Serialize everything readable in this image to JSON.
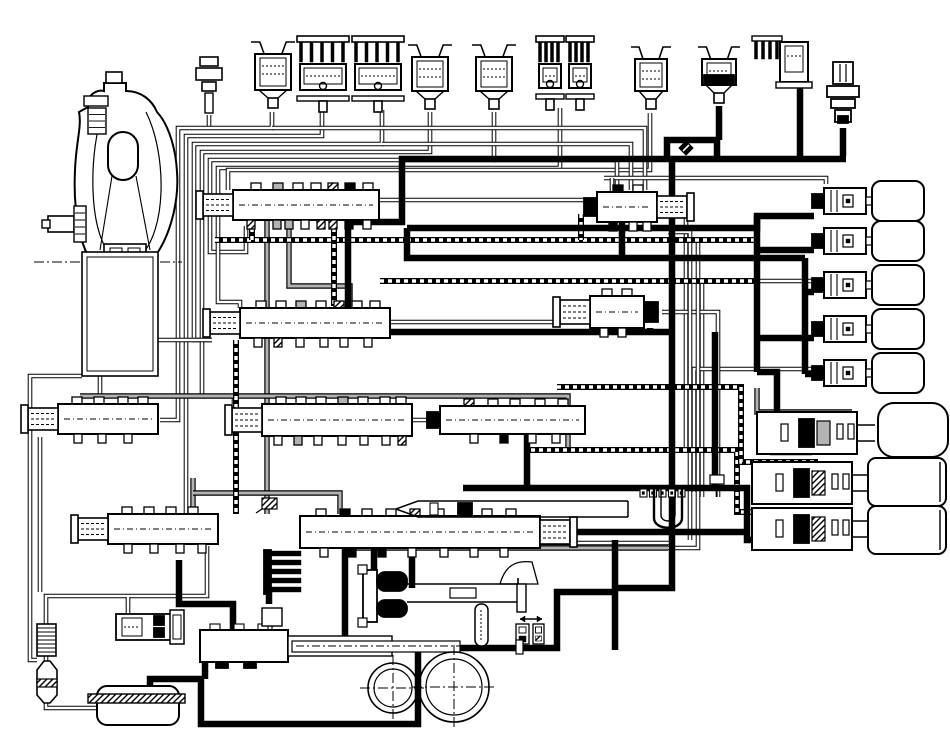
{
  "canvas": {
    "width": 950,
    "height": 742,
    "background": "#ffffff",
    "ink": "#000000",
    "gray": "#b3b3b3"
  },
  "diagram": {
    "kind": "transmission-hydraulic-circuit",
    "visible_text": [],
    "line_kinds": [
      "thin-double-passage",
      "gray-passage",
      "hatched-passage",
      "thick-supply"
    ]
  },
  "components": [
    {
      "name": "torque-converter",
      "type": "tc"
    },
    {
      "name": "converter-drum",
      "type": "drum"
    },
    {
      "name": "fluid-temp-sensor",
      "type": "sensor",
      "x": 194,
      "y": 55
    },
    {
      "name": "shift-solenoid-1",
      "type": "sol_cup",
      "x": 251,
      "y": 40,
      "w": 44,
      "h": 72
    },
    {
      "name": "linear-solenoid-1a",
      "type": "sol_fin",
      "x": 297,
      "y": 36,
      "w": 52,
      "h": 76
    },
    {
      "name": "linear-solenoid-1b",
      "type": "sol_fin",
      "x": 352,
      "y": 36,
      "w": 52,
      "h": 76
    },
    {
      "name": "shift-solenoid-2",
      "type": "sol_cup",
      "x": 408,
      "y": 43,
      "w": 44,
      "h": 70
    },
    {
      "name": "shift-solenoid-3",
      "type": "sol_cup",
      "x": 472,
      "y": 43,
      "w": 44,
      "h": 70
    },
    {
      "name": "linear-solenoid-2a",
      "type": "sol_fin",
      "x": 536,
      "y": 36,
      "w": 28,
      "h": 74
    },
    {
      "name": "linear-solenoid-2b",
      "type": "sol_fin",
      "x": 566,
      "y": 36,
      "w": 28,
      "h": 74
    },
    {
      "name": "shift-solenoid-4",
      "type": "sol_cup",
      "x": 631,
      "y": 45,
      "w": 40,
      "h": 68
    },
    {
      "name": "shift-solenoid-5-energized",
      "type": "sol_cup",
      "x": 698,
      "y": 45,
      "w": 42,
      "h": 62,
      "black": true
    },
    {
      "name": "linear-solenoid-3",
      "type": "sol_elbow",
      "x": 752,
      "y": 36
    },
    {
      "name": "pressure-switch",
      "type": "pswitch",
      "x": 824,
      "y": 62
    },
    {
      "name": "check-ball",
      "type": "ball",
      "x": 686,
      "y": 148
    },
    {
      "name": "vent-port",
      "type": "vent",
      "x": 262,
      "y": 498
    },
    {
      "name": "accumulator-1",
      "type": "check_accu",
      "x": 824,
      "y": 188
    },
    {
      "name": "accumulator-2",
      "type": "check_accu",
      "x": 824,
      "y": 228
    },
    {
      "name": "accumulator-3",
      "type": "check_accu",
      "x": 824,
      "y": 272
    },
    {
      "name": "accumulator-4",
      "type": "check_accu",
      "x": 824,
      "y": 316
    },
    {
      "name": "accumulator-5",
      "type": "check_accu",
      "x": 824,
      "y": 360
    },
    {
      "name": "servo-1",
      "type": "servo",
      "x": 757,
      "y": 412,
      "variant": 1
    },
    {
      "name": "servo-2",
      "type": "servo",
      "x": 752,
      "y": 462,
      "variant": 2
    },
    {
      "name": "servo-3",
      "type": "servo",
      "x": 752,
      "y": 508,
      "variant": 3
    },
    {
      "name": "regulator-valve",
      "type": "valve",
      "x": 233,
      "y": 190,
      "w": 146,
      "h": 30,
      "cap": "left",
      "notches": [
        [
          18,
          "w"
        ],
        [
          40,
          "g"
        ],
        [
          60,
          "w"
        ],
        [
          78,
          "w"
        ],
        [
          95,
          "h"
        ],
        [
          112,
          "k"
        ],
        [
          130,
          "w"
        ]
      ],
      "stubs": [
        [
          14,
          "h"
        ],
        [
          40,
          "g"
        ],
        [
          52,
          "g"
        ],
        [
          68,
          "w"
        ],
        [
          84,
          "h"
        ],
        [
          96,
          "h"
        ],
        [
          112,
          "k"
        ],
        [
          130,
          "w"
        ]
      ]
    },
    {
      "name": "lockup-relay-valve",
      "type": "valve",
      "x": 597,
      "y": 192,
      "w": 60,
      "h": 30,
      "cap": "right",
      "blackL": true,
      "notches": [
        [
          16,
          "k"
        ],
        [
          36,
          "w"
        ]
      ],
      "stubs": [
        [
          12,
          "k"
        ],
        [
          32,
          "w"
        ],
        [
          46,
          "w"
        ]
      ]
    },
    {
      "name": "shift-valve-1",
      "type": "valve",
      "x": 240,
      "y": 308,
      "w": 150,
      "h": 30,
      "cap": "left",
      "notches": [
        [
          16,
          "w"
        ],
        [
          36,
          "w"
        ],
        [
          56,
          "g"
        ],
        [
          76,
          "w"
        ],
        [
          94,
          "h"
        ],
        [
          112,
          "w"
        ],
        [
          130,
          "w"
        ]
      ],
      "stubs": [
        [
          14,
          "w"
        ],
        [
          34,
          "h"
        ],
        [
          56,
          "w"
        ],
        [
          80,
          "w"
        ],
        [
          100,
          "w"
        ],
        [
          124,
          "w"
        ]
      ]
    },
    {
      "name": "shift-valve-2",
      "type": "valve",
      "x": 590,
      "y": 296,
      "w": 54,
      "h": 32,
      "cap": "left",
      "blackR": true,
      "notches": [
        [
          12,
          "w"
        ],
        [
          32,
          "w"
        ]
      ],
      "stubs": [
        [
          10,
          "w"
        ],
        [
          28,
          "w"
        ]
      ]
    },
    {
      "name": "modulator-valve-left",
      "type": "valve",
      "x": 58,
      "y": 404,
      "w": 100,
      "h": 30,
      "cap": "left",
      "notches": [
        [
          14,
          "w"
        ],
        [
          36,
          "w"
        ],
        [
          60,
          "w"
        ],
        [
          80,
          "w"
        ]
      ],
      "stubs": [
        [
          16,
          "w"
        ],
        [
          40,
          "w"
        ],
        [
          66,
          "w"
        ]
      ]
    },
    {
      "name": "shift-valve-3",
      "type": "valve",
      "x": 262,
      "y": 404,
      "w": 150,
      "h": 32,
      "cap": "left",
      "notches": [
        [
          14,
          "w"
        ],
        [
          34,
          "w"
        ],
        [
          54,
          "w"
        ],
        [
          76,
          "g"
        ],
        [
          96,
          "w"
        ],
        [
          118,
          "w"
        ],
        [
          134,
          "w"
        ]
      ],
      "stubs": [
        [
          12,
          "w"
        ],
        [
          32,
          "g"
        ],
        [
          52,
          "w"
        ],
        [
          76,
          "w"
        ],
        [
          98,
          "w"
        ],
        [
          120,
          "w"
        ],
        [
          136,
          "h"
        ]
      ]
    },
    {
      "name": "shift-valve-4",
      "type": "valve",
      "x": 440,
      "y": 406,
      "w": 145,
      "h": 28,
      "blackL": true,
      "notches": [
        [
          24,
          "h"
        ],
        [
          48,
          "w"
        ],
        [
          70,
          "w"
        ],
        [
          95,
          "w"
        ],
        [
          118,
          "w"
        ]
      ],
      "stubs": [
        [
          30,
          "w"
        ],
        [
          60,
          "k"
        ],
        [
          88,
          "w"
        ],
        [
          112,
          "w"
        ]
      ]
    },
    {
      "name": "low-coast-valve",
      "type": "valve",
      "x": 108,
      "y": 514,
      "w": 110,
      "h": 30,
      "cap": "left",
      "notches": [
        [
          14,
          "w"
        ],
        [
          36,
          "w"
        ],
        [
          58,
          "w"
        ],
        [
          80,
          "w"
        ]
      ],
      "stubs": [
        [
          16,
          "w"
        ],
        [
          42,
          "w"
        ],
        [
          68,
          "w"
        ],
        [
          90,
          "w"
        ]
      ]
    },
    {
      "name": "sequence-valve",
      "type": "valve",
      "x": 300,
      "y": 516,
      "w": 240,
      "h": 32,
      "cap": "right",
      "notches": [
        [
          16,
          "w"
        ],
        [
          40,
          "k"
        ],
        [
          62,
          "w"
        ],
        [
          86,
          "w"
        ],
        [
          110,
          "h"
        ],
        [
          134,
          "w"
        ],
        [
          158,
          "w"
        ],
        [
          182,
          "w"
        ],
        [
          206,
          "w"
        ]
      ],
      "stubs": [
        [
          20,
          "w"
        ],
        [
          48,
          "k"
        ],
        [
          78,
          "k"
        ],
        [
          108,
          "w"
        ],
        [
          140,
          "w"
        ],
        [
          170,
          "w"
        ],
        [
          200,
          "w"
        ]
      ]
    },
    {
      "name": "throttle-cam-valve",
      "type": "fvalve"
    },
    {
      "name": "thermo-element",
      "type": "utube"
    },
    {
      "name": "detent-comb",
      "type": "comb"
    },
    {
      "name": "manual-valve",
      "type": "mvalve"
    },
    {
      "name": "governor-assembly",
      "type": "tele"
    },
    {
      "name": "cutback-valve",
      "type": "lvalve"
    },
    {
      "name": "oil-pump-gears",
      "type": "pump"
    },
    {
      "name": "oil-pan",
      "type": "pan"
    },
    {
      "name": "oil-cooler",
      "type": "cooler"
    },
    {
      "name": "suction-filter",
      "type": "funnel"
    }
  ],
  "lines": [
    {
      "kind": "thin",
      "d": "M209 115 V128"
    },
    {
      "kind": "thin",
      "d": "M272 112 V128 H178 V420 H160"
    },
    {
      "kind": "thin",
      "d": "M322 110 V136 H186 V540 H108"
    },
    {
      "kind": "thin",
      "d": "M382 110 V144 H194 V340 H212"
    },
    {
      "kind": "thin",
      "d": "M430 112 V152 H202 V396 H234 V404"
    },
    {
      "kind": "thin",
      "d": "M494 112 V160 H210 V252 H246 V226"
    },
    {
      "kind": "thin",
      "d": "M560 108 V168 H218 V302 H240 V308"
    },
    {
      "kind": "thin",
      "d": "M650 113 V170 H228 V190"
    },
    {
      "kind": "thin",
      "d": "M272 128 H645 V190"
    },
    {
      "kind": "thin",
      "d": "M382 144 H631 V190"
    },
    {
      "kind": "thin",
      "d": "M494 160 H617 V190"
    },
    {
      "kind": "thin",
      "d": "M604 178 H826 V184"
    },
    {
      "kind": "thin",
      "d": "M612 192 V178"
    },
    {
      "kind": "thin",
      "d": "M820 281 H702 V497"
    },
    {
      "kind": "thin",
      "d": "M820 369 H694 V492"
    },
    {
      "kind": "thin",
      "d": "M665 204 H686 V448"
    },
    {
      "kind": "thin",
      "d": "M662 312 H718 V497"
    },
    {
      "kind": "thin",
      "d": "M378 200 H597"
    },
    {
      "kind": "thin",
      "d": "M390 322 H560"
    },
    {
      "kind": "thin",
      "d": "M412 420 H560 V434"
    },
    {
      "kind": "thin",
      "d": "M100 376 V404"
    },
    {
      "kind": "thin",
      "d": "M140 376 V340 H212"
    },
    {
      "kind": "thin",
      "d": "M82 376 H30 V660 H37"
    },
    {
      "kind": "thin",
      "d": "M40 437 V592"
    },
    {
      "kind": "thin",
      "d": "M46 624 V596 H207 V546"
    },
    {
      "kind": "thin",
      "d": "M46 656 V670"
    },
    {
      "kind": "thin",
      "d": "M46 703 V708 H98"
    },
    {
      "kind": "thin",
      "d": "M128 614 V597"
    },
    {
      "kind": "thin",
      "d": "M668 232 H690 V540"
    },
    {
      "kind": "thin",
      "d": "M660 240 H698 V548 H620"
    },
    {
      "kind": "thin",
      "d": "M350 543 H672 V512"
    },
    {
      "kind": "gray",
      "d": "M289 220 V286 H350 V306"
    },
    {
      "kind": "gray",
      "d": "M267 220 V514"
    },
    {
      "kind": "gray",
      "d": "M80 396 H568 V448"
    },
    {
      "kind": "gray",
      "d": "M757 388 V412 H852"
    },
    {
      "kind": "gray",
      "d": "M193 478 V533"
    },
    {
      "kind": "gray",
      "d": "M193 493 H340 V514"
    },
    {
      "kind": "gray",
      "d": "M354 548 H668"
    },
    {
      "kind": "hatch",
      "d": "M215 240 H758"
    },
    {
      "kind": "hatch",
      "d": "M252 220 V240"
    },
    {
      "kind": "hatch",
      "d": "M581 214 V240"
    },
    {
      "kind": "hatch",
      "d": "M380 281 H758"
    },
    {
      "kind": "hatch",
      "d": "M334 220 V306"
    },
    {
      "kind": "hatch",
      "d": "M236 340 V514"
    },
    {
      "kind": "hatch",
      "d": "M527 438 V450 H737 V512 H818"
    },
    {
      "kind": "hatch",
      "d": "M557 387 H741 V462 H818"
    },
    {
      "kind": "thick",
      "d": "M719 106 V140"
    },
    {
      "kind": "thick",
      "d": "M794 64 H800 V156"
    },
    {
      "kind": "thick",
      "d": "M843 128 V156"
    },
    {
      "kind": "thick",
      "d": "M348 210 V222 H402 V159 H846"
    },
    {
      "kind": "thick",
      "d": "M667 159 V140 H717 V159"
    },
    {
      "kind": "thick",
      "d": "M672 159 V588 H615"
    },
    {
      "kind": "thick",
      "d": "M615 540 V650"
    },
    {
      "kind": "thick",
      "d": "M407 228 H757 V216 H814"
    },
    {
      "kind": "thick",
      "d": "M407 228 V258 H805"
    },
    {
      "kind": "thick",
      "d": "M622 222 V258"
    },
    {
      "kind": "thick",
      "d": "M757 216 V372"
    },
    {
      "kind": "thick",
      "d": "M757 250 H814"
    },
    {
      "kind": "thick",
      "d": "M757 338 H814"
    },
    {
      "kind": "thick",
      "d": "M805 258 V374"
    },
    {
      "kind": "thick",
      "d": "M805 292 H814"
    },
    {
      "kind": "thick",
      "d": "M805 374 H814"
    },
    {
      "kind": "thick",
      "d": "M348 222 V332 H672"
    },
    {
      "kind": "thick",
      "d": "M650 328 V332"
    },
    {
      "kind": "thick",
      "d": "M715 332 V488"
    },
    {
      "kind": "thick",
      "d": "M527 432 V488"
    },
    {
      "kind": "thick",
      "d": "M463 488 H747 V540 H800"
    },
    {
      "kind": "thick",
      "d": "M463 532 H747"
    },
    {
      "kind": "thick",
      "d": "M374 532 V574"
    },
    {
      "kind": "thick",
      "d": "M412 532 V588"
    },
    {
      "kind": "thick",
      "d": "M345 548 V648 H557 V592 H615"
    },
    {
      "kind": "thick",
      "d": "M418 648 V724 H201 V679 H150 V688"
    },
    {
      "kind": "thick",
      "d": "M205 658 V679"
    },
    {
      "kind": "thick",
      "d": "M179 560 V604 H233 V630"
    },
    {
      "kind": "thick",
      "d": "M269 592 V604"
    },
    {
      "kind": "thick",
      "d": "M757 372 H777 V420"
    },
    {
      "kind": "thick",
      "d": "M770 452 H812"
    }
  ]
}
